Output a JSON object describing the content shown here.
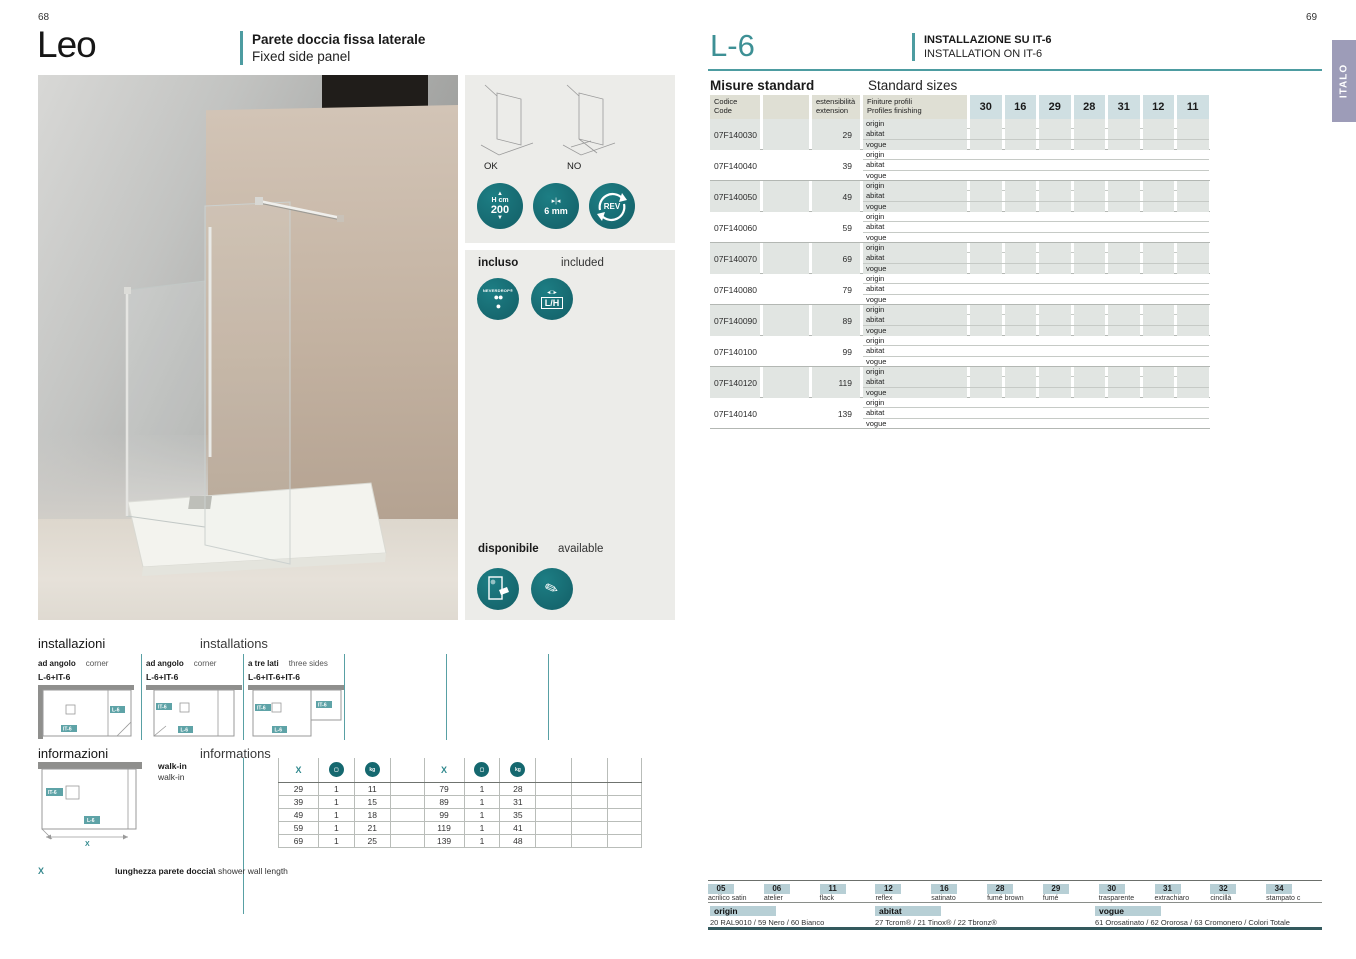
{
  "page": {
    "left_number": "68",
    "right_number": "69",
    "side_tab": "ITALO"
  },
  "left": {
    "title": "Leo",
    "subtitle_it": "Parete doccia fissa laterale",
    "subtitle_en": "Fixed side panel",
    "compat": {
      "ok": "OK",
      "no": "NO"
    },
    "badges": {
      "height_line1": "H cm",
      "height_line2": "200",
      "glass_label": "6 mm",
      "rev": "REV",
      "neverdrop": "NEVERDROP®",
      "lh": "L/H"
    },
    "incluso": {
      "label_it": "incluso",
      "label_en": "included"
    },
    "disponibile": {
      "label_it": "disponibile",
      "label_en": "available"
    },
    "installazioni": {
      "title_it": "installazioni",
      "title_en": "installations",
      "items": [
        {
          "name_it": "ad angolo",
          "name_en": "corner",
          "code": "L-6+IT-6"
        },
        {
          "name_it": "ad angolo",
          "name_en": "corner",
          "code": "L-6+IT-6"
        },
        {
          "name_it": "a tre lati",
          "name_en": "three sides",
          "code": "L-6+IT-6+IT-6"
        }
      ]
    },
    "informazioni": {
      "title_it": "informazioni",
      "title_en": "informations",
      "walkin_it": "walk-in",
      "walkin_en": "walk-in",
      "diagram_labels": {
        "it6": "IT-6",
        "l6": "L-6",
        "x": "X"
      },
      "note_x": "X",
      "note_text_it": "lunghezza parete doccia\\",
      "note_text_en": " shower wall length",
      "table": {
        "header_x": "X",
        "left_rows": [
          [
            "29",
            "1",
            "11"
          ],
          [
            "39",
            "1",
            "15"
          ],
          [
            "49",
            "1",
            "18"
          ],
          [
            "59",
            "1",
            "21"
          ],
          [
            "69",
            "1",
            "25"
          ]
        ],
        "right_rows": [
          [
            "79",
            "1",
            "28"
          ],
          [
            "89",
            "1",
            "31"
          ],
          [
            "99",
            "1",
            "35"
          ],
          [
            "119",
            "1",
            "41"
          ],
          [
            "139",
            "1",
            "48"
          ]
        ]
      }
    }
  },
  "right": {
    "model": "L-6",
    "installation_it": "INSTALLAZIONE SU IT-6",
    "installation_en": "INSTALLATION ON IT-6",
    "sizes": {
      "title_it": "Misure standard",
      "title_en": "Standard sizes",
      "header": {
        "code_it": "Codice",
        "code_en": "Code",
        "ext_it": "estensibilità",
        "ext_en": "extension",
        "fin_it": "Finiture profili",
        "fin_en": "Profiles finishing"
      },
      "size_columns": [
        "30",
        "16",
        "29",
        "28",
        "31",
        "12",
        "11"
      ],
      "finishes": [
        "origin",
        "abitat",
        "vogue"
      ],
      "rows": [
        {
          "code": "07F140030",
          "ext": "29"
        },
        {
          "code": "07F140040",
          "ext": "39"
        },
        {
          "code": "07F140050",
          "ext": "49"
        },
        {
          "code": "07F140060",
          "ext": "59"
        },
        {
          "code": "07F140070",
          "ext": "69"
        },
        {
          "code": "07F140080",
          "ext": "79"
        },
        {
          "code": "07F140090",
          "ext": "89"
        },
        {
          "code": "07F140100",
          "ext": "99"
        },
        {
          "code": "07F140120",
          "ext": "119"
        },
        {
          "code": "07F140140",
          "ext": "139"
        }
      ]
    },
    "legend": {
      "glass": [
        {
          "code": "05",
          "label": "acrilico satin"
        },
        {
          "code": "06",
          "label": "atelier"
        },
        {
          "code": "11",
          "label": "flack"
        },
        {
          "code": "12",
          "label": "reflex"
        },
        {
          "code": "16",
          "label": "satinato"
        },
        {
          "code": "28",
          "label": "fumé brown"
        },
        {
          "code": "29",
          "label": "fumé"
        },
        {
          "code": "30",
          "label": "trasparente"
        },
        {
          "code": "31",
          "label": "extrachiaro"
        },
        {
          "code": "32",
          "label": "cincillà"
        },
        {
          "code": "34",
          "label": "stampato c"
        }
      ],
      "profiles": [
        {
          "name": "origin",
          "desc": "20 RAL9010 / 59 Nero / 60 Bianco"
        },
        {
          "name": "abitat",
          "desc": "27 Tcrom® / 21 Tinox® / 22 Tbronz®"
        },
        {
          "name": "vogue",
          "desc": "61 Orosatinato / 62 Ororosa / 63 Cromonero / Colori Totale"
        }
      ]
    }
  },
  "colors": {
    "teal_accent": "#4d9ca1",
    "badge_teal": "#15686f",
    "chip_blue": "#b7cfd5",
    "header_beige": "#dfdfd4",
    "col_header_blue": "#cfdfe2",
    "row_shade": "#e1e5e2",
    "tab_purple": "#9d9cb8",
    "icon_col_bg": "#ecece9"
  }
}
